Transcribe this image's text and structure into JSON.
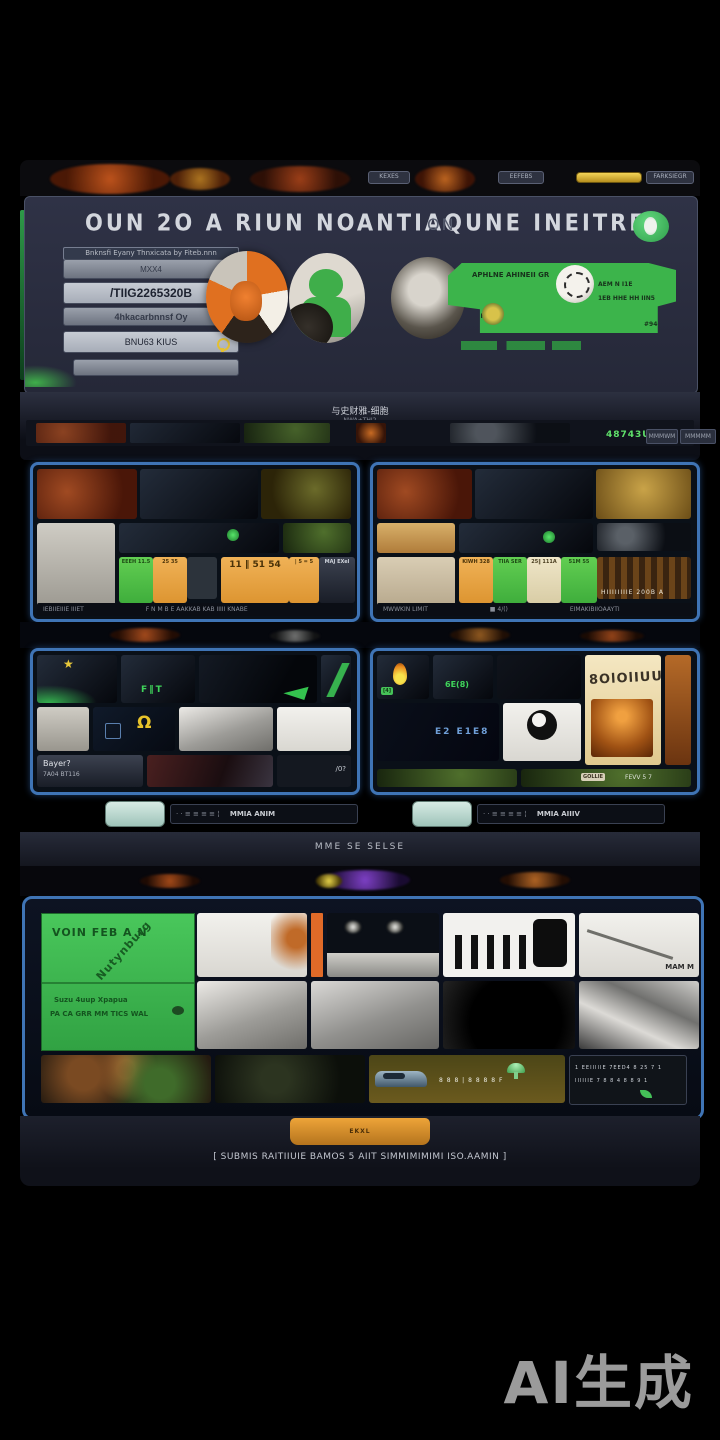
{
  "colors": {
    "accent_green": "#3cb44b",
    "accent_orange": "#e8982f",
    "panel_border_blue": "#3f74b5",
    "mint_button": "#cfe6df",
    "counter_green": "#5fe06a",
    "bezel": "#262a38"
  },
  "header_strip": {
    "left_chip": "KEXES",
    "mid_chip": "EEFEBS",
    "right_label": "FARKSIEGR"
  },
  "top_panel": {
    "title": "OUN 2O A RIUN NOANTIAQUNE INEITREO",
    "title_ghost": "ON",
    "form": {
      "caption": "Bnknsfi Eyany  Thnxicata by  Fiteb.nnn",
      "field1": "MXX4",
      "field2": "/TIIG2265320B",
      "field3": "4hkacarbnnsf Oy",
      "field4": "BNU63 KIUS",
      "field5": ""
    },
    "banner": {
      "line1": "APHLNE AHINEII GR",
      "line2": "AEM N I1E",
      "line3": "1EB HHE  HH IIN5",
      "line4": "F33 F UU",
      "line5": "#94C"
    }
  },
  "status_strip": {
    "center": "与史财雅-细胞",
    "center_sub": "—NWA+THI2—",
    "counter": "48743U",
    "button1": "MMMWM",
    "button2": "MMMMM"
  },
  "mid_left_panel": {
    "tile1": "EEEH 11.5",
    "tile2": "25 35",
    "tile4": "11 ‖ 51 54",
    "tile5": "| 5 = 5",
    "tile6": "MAJ EXel",
    "footer_left": "IEBIIEIIIE IIIET",
    "footer_right": "F N M B E AAKKAB KAB IIIII KNABE"
  },
  "mid_right_panel": {
    "tile1": "KIWH 328",
    "tile2": "TIIA SER",
    "tile3": "25‖ 111A",
    "tile4": "51M 55",
    "tile5": "HIIIIIIIIE 200B A",
    "footer_left": "MWWKIN LIMIT",
    "footer_mid": "■ 4/()",
    "footer_right": "EIMAKIBIIOAAYTI"
  },
  "grid_left_panel": {
    "green_glyphs": "F‖T",
    "omega": "Ω",
    "row3_label1": "Bayer?",
    "row3_label2": "7A04 BT116",
    "row3_right": "/0?"
  },
  "grid_right_panel": {
    "chip": "[4]",
    "green_text": "6E(8)",
    "cream_text": "8OlOlIUU",
    "blue_glyphs": "E2 E1E8",
    "bottom_chip": "GOLLIE",
    "bottom_text": "FEVV 5 7"
  },
  "control_bar_left": {
    "ticks": "· ·  ≡ ≡ ≡ ≡ ¦",
    "label": "MMIA ANIM"
  },
  "control_bar_right": {
    "ticks": "· ·  ≡ ≡ ≡ ≡ ¦",
    "label": "MMIA AIIIV"
  },
  "divider_label": "MME SE  SELSE",
  "bottom_panel": {
    "green_card": {
      "line1": "VOIN FEB A N",
      "diag": "Nutynburg",
      "line2": "Suzu  4uup Xpapua",
      "line3": "PA CA GRR MM TICS   WAL"
    },
    "diag_scribble": "MAM M",
    "car_strip": {
      "glyphs": "8 8 8 | 8 8 8 8 F",
      "inset_line1": "1 EEIIIIIE 7EED4 8 25 7 1",
      "inset_line2": "IIIIIIE 7 8 8 4 8 8 9 1"
    }
  },
  "bottom_bar": {
    "tab": "EKXL",
    "message": "[ SUBMIS RAITIIUIE BAMOS 5 AIIT SIMMIMIMIMI ISO.AAMIN ]"
  },
  "watermark": "AI生成",
  "icons": {
    "star": "★"
  }
}
